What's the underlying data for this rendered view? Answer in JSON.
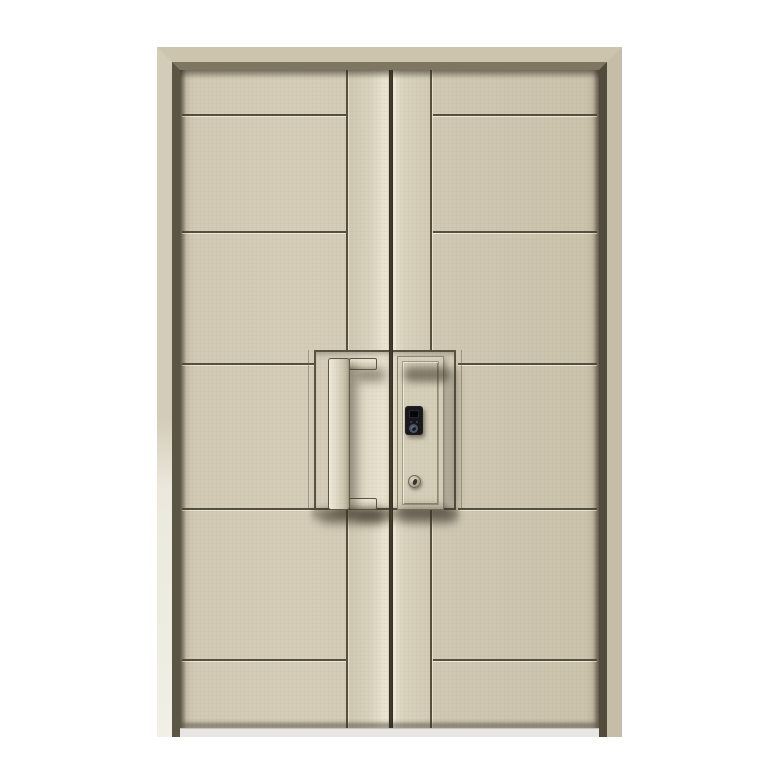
{
  "scene": {
    "description": "Studio product photo of a cream beige double-leaf security entry door with matching frame. Each leaf has wide horizontal grooved bands and a full-height centre stile. The left leaf carries a long rectangular pull handle; the right leaf carries a raised lock escutcheon with a black fingerprint smart-lock module and a cylinder keyhole below it. The doors stand on a pale threshold against a plain white background.",
    "background_color": "#ffffff",
    "leaf_count": 2,
    "groove_bands_per_leaf": 6
  },
  "colors": {
    "background": "#ffffff",
    "frame_face": "#ccc4ad",
    "frame_face_left": "#d3ccb8",
    "frame_face_right": "#c5bda7",
    "frame_reveal_dark": "#5b5544",
    "leaf": "#d6cdb9",
    "leaf_right": "#cfc6b1",
    "stile_highlight": "#ece6d4",
    "groove_line": "#564f3d",
    "gap": "#47422f",
    "handle_light": "#f1ecdc",
    "handle_dark": "#a49c86",
    "lock_body": "#17171b",
    "fingerprint_ring": "#4b5468",
    "keyhole_metal": "#b3ac9b",
    "threshold": "#e7e6e2",
    "shadow": "rgba(56,50,38,0.5)"
  },
  "parts": {
    "frame": "door frame",
    "left_leaf": "left door leaf",
    "right_leaf": "right door leaf",
    "centre_stiles": "vertical centre stiles",
    "handle": "rectangular pull handle",
    "escutcheon": "raised lock plate",
    "smart_lock": "fingerprint smart lock module",
    "keyhole": "cylinder keyhole",
    "threshold": "floor threshold"
  }
}
